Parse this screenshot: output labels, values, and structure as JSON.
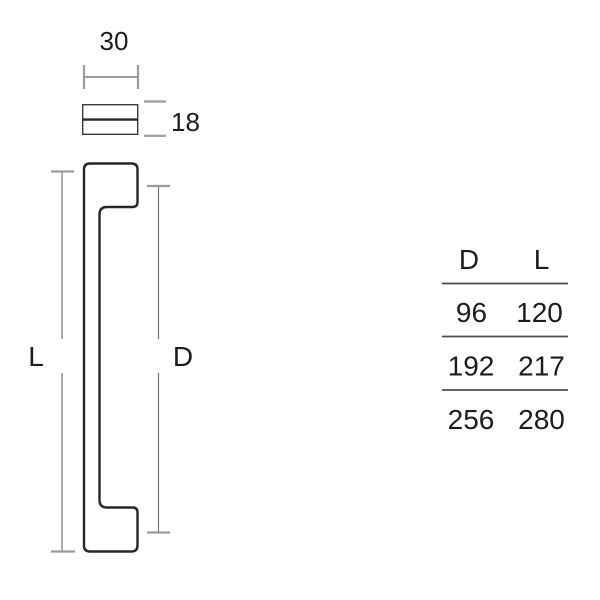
{
  "colors": {
    "background": "#ffffff",
    "outline": "#262626",
    "section_border": "#3a3a3a",
    "dimension_line": "#757575",
    "dimension_tick": "#9a9a9a",
    "table_rule": "#4d4d4d",
    "text": "#1c1c1c"
  },
  "top_view": {
    "width_value": "30",
    "depth_value": "18"
  },
  "front_view": {
    "length_label": "L",
    "centers_label": "D"
  },
  "size_table": {
    "headers": {
      "d": "D",
      "l": "L"
    },
    "rows": [
      {
        "d": "96",
        "l": "120"
      },
      {
        "d": "192",
        "l": "217"
      },
      {
        "d": "256",
        "l": "280"
      }
    ]
  }
}
